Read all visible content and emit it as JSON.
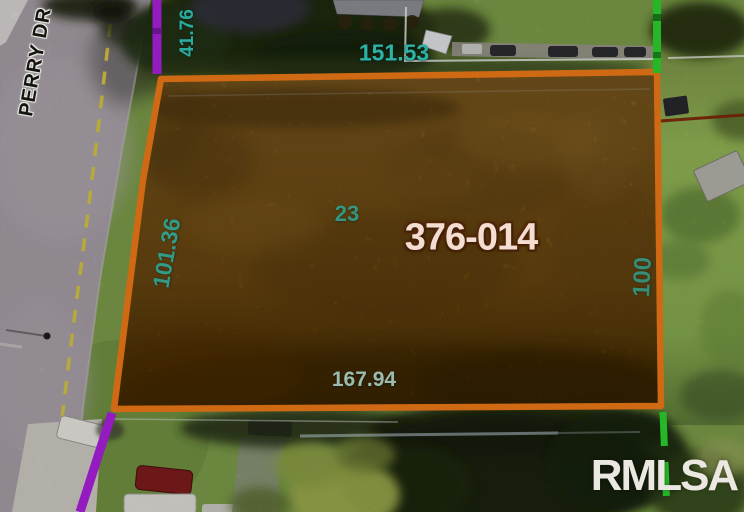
{
  "map": {
    "street_label": "PERRY DR",
    "parcel": {
      "id_label": "376-014",
      "lot_number": "23",
      "dimensions": {
        "left_upper": "41.76",
        "top": "151.53",
        "left": "101.36",
        "right": "100",
        "bottom": "167.94"
      }
    },
    "watermark": "RMLSA",
    "colors": {
      "parcel_outline": "#ed7817",
      "boundary_purple": "#a81fdb",
      "boundary_green": "#2bd22e",
      "dimension_text": "#2cb2a6",
      "parcel_id_text": "#f4ded2",
      "road_centerline_yellow": "#d3c244",
      "watermark_text": "#eae8e1"
    }
  }
}
